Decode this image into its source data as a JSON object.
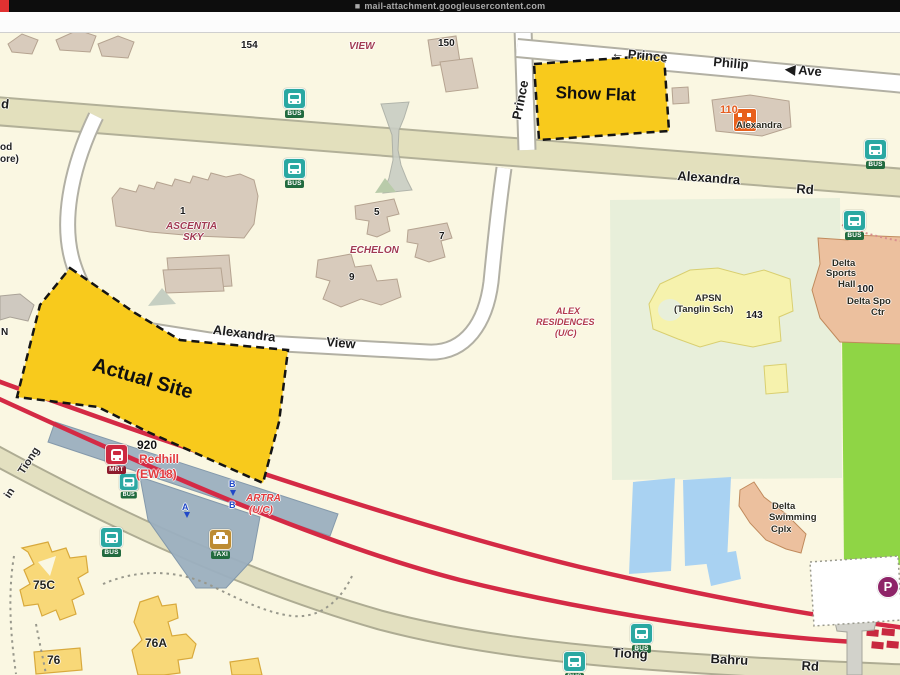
{
  "browser": {
    "url_prefix_glyph": "■",
    "url": "mail-attachment.googleusercontent.com"
  },
  "map": {
    "site_overlays": [
      {
        "name": "show-flat",
        "label": "Show Flat"
      },
      {
        "name": "actual-site",
        "label": "Actual Site"
      }
    ],
    "icon_labels": {
      "bus": "BUS",
      "mrt": "MRT",
      "taxi": "TAXI",
      "parking": "P"
    },
    "accent_colors": {
      "site_yellow": "#f8ca1c",
      "rail_red": "#d42a45",
      "bus_teal": "#2aa8a2",
      "mrt_red": "#cd2840",
      "parking_purple": "#8e2468"
    },
    "labels": [
      {
        "t": "154",
        "x": 241,
        "y": 40,
        "cls": "num"
      },
      {
        "t": "VIEW",
        "x": 349,
        "y": 41,
        "cls": "condo"
      },
      {
        "t": "150",
        "x": 438,
        "y": 38,
        "cls": "num"
      },
      {
        "t": "← Prince",
        "x": 612,
        "y": 45,
        "r": 5,
        "cls": "rd"
      },
      {
        "t": "Philip",
        "x": 714,
        "y": 54,
        "r": 5,
        "cls": "rd"
      },
      {
        "t": "◀ Ave",
        "x": 786,
        "y": 61,
        "r": 5,
        "cls": "rd"
      },
      {
        "t": "Prince",
        "x": 509,
        "y": 118,
        "r": -79,
        "cls": "rd"
      },
      {
        "t": "d",
        "x": 2,
        "y": 96,
        "r": 6,
        "cls": "rd"
      },
      {
        "t": "od",
        "x": 0,
        "y": 142,
        "cls": "partial"
      },
      {
        "t": "ore)",
        "x": 0,
        "y": 154,
        "cls": "partial"
      },
      {
        "t": "Alexandra",
        "x": 678,
        "y": 168,
        "r": 4,
        "cls": "rd"
      },
      {
        "t": "Rd",
        "x": 797,
        "y": 181,
        "r": 4,
        "cls": "rd"
      },
      {
        "t": "Alexandra",
        "x": 214,
        "y": 322,
        "r": 7,
        "cls": "rd"
      },
      {
        "t": "View",
        "x": 327,
        "y": 334,
        "r": 5,
        "cls": "rd"
      },
      {
        "t": "1",
        "x": 180,
        "y": 206,
        "cls": "num"
      },
      {
        "t": "ASCENTIA",
        "x": 166,
        "y": 221,
        "cls": "condo"
      },
      {
        "t": "SKY",
        "x": 183,
        "y": 232,
        "cls": "condo"
      },
      {
        "t": "5",
        "x": 374,
        "y": 207,
        "cls": "num"
      },
      {
        "t": "7",
        "x": 439,
        "y": 231,
        "cls": "num"
      },
      {
        "t": "ECHELON",
        "x": 350,
        "y": 245,
        "cls": "condo"
      },
      {
        "t": "9",
        "x": 349,
        "y": 272,
        "cls": "num"
      },
      {
        "t": "ALEX",
        "x": 556,
        "y": 306,
        "cls": "condo-sm"
      },
      {
        "t": "RESIDENCES",
        "x": 536,
        "y": 317,
        "cls": "condo-sm"
      },
      {
        "t": "(U/C)",
        "x": 555,
        "y": 328,
        "cls": "condo-sm"
      },
      {
        "t": "APSN",
        "x": 695,
        "y": 293,
        "cls": "dark-sm"
      },
      {
        "t": "(Tanglin Sch)",
        "x": 674,
        "y": 304,
        "cls": "dark-sm"
      },
      {
        "t": "143",
        "x": 746,
        "y": 310,
        "cls": "num"
      },
      {
        "t": "110",
        "x": 720,
        "y": 104,
        "cls": "orange"
      },
      {
        "t": "Alexandra",
        "x": 736,
        "y": 120,
        "cls": "dark-sm"
      },
      {
        "t": "Delta",
        "x": 832,
        "y": 258,
        "cls": "dark-sm"
      },
      {
        "t": "Sports",
        "x": 826,
        "y": 268,
        "cls": "dark-sm"
      },
      {
        "t": "Hall",
        "x": 838,
        "y": 279,
        "cls": "dark-sm"
      },
      {
        "t": "100",
        "x": 857,
        "y": 284,
        "cls": "num"
      },
      {
        "t": "Delta Spo",
        "x": 847,
        "y": 296,
        "cls": "dark-sm"
      },
      {
        "t": "Ctr",
        "x": 871,
        "y": 307,
        "cls": "dark-sm"
      },
      {
        "t": "Delta",
        "x": 772,
        "y": 501,
        "cls": "dark-sm"
      },
      {
        "t": "Swimming",
        "x": 769,
        "y": 512,
        "cls": "dark-sm"
      },
      {
        "t": "Cplx",
        "x": 771,
        "y": 524,
        "cls": "dark-sm"
      },
      {
        "t": "920",
        "x": 137,
        "y": 438,
        "cls": "num-lg"
      },
      {
        "t": "Redhill",
        "x": 139,
        "y": 452,
        "cls": "mrt-name"
      },
      {
        "t": "(EW18)",
        "x": 136,
        "y": 467,
        "cls": "mrt-name"
      },
      {
        "t": "ARTRA",
        "x": 246,
        "y": 493,
        "cls": "artra"
      },
      {
        "t": "(U/C)",
        "x": 249,
        "y": 505,
        "cls": "artra"
      },
      {
        "t": "B",
        "x": 229,
        "y": 479,
        "cls": "stop"
      },
      {
        "t": "B",
        "x": 229,
        "y": 500,
        "cls": "stop"
      },
      {
        "t": "A",
        "x": 182,
        "y": 502,
        "cls": "stop"
      },
      {
        "t": "75C",
        "x": 33,
        "y": 578,
        "cls": "hdb"
      },
      {
        "t": "76A",
        "x": 145,
        "y": 636,
        "cls": "hdb"
      },
      {
        "t": "76",
        "x": 47,
        "y": 653,
        "cls": "hdb"
      },
      {
        "t": "Tiong",
        "x": 613,
        "y": 645,
        "r": 3,
        "cls": "rd"
      },
      {
        "t": "Bahru",
        "x": 711,
        "y": 651,
        "r": 3,
        "cls": "rd"
      },
      {
        "t": "Rd",
        "x": 802,
        "y": 658,
        "r": 3,
        "cls": "rd"
      },
      {
        "t": "Tiong",
        "x": 16,
        "y": 470,
        "r": -57,
        "cls": "rd-sm"
      },
      {
        "t": "in",
        "x": 2,
        "y": 494,
        "r": -57,
        "cls": "rd-sm"
      },
      {
        "t": "N",
        "x": 1,
        "y": 327,
        "cls": "num"
      },
      {
        "t": "Show Flat",
        "x": 556,
        "y": 83,
        "r": 2,
        "cls": "site-label",
        "fs": 17
      },
      {
        "t": "Actual Site",
        "x": 96,
        "y": 354,
        "r": 16,
        "cls": "site-label",
        "fs": 20
      }
    ],
    "icons": [
      {
        "type": "bus",
        "x": 283,
        "y": 88
      },
      {
        "type": "bus",
        "x": 283,
        "y": 158
      },
      {
        "type": "bus",
        "x": 864,
        "y": 139
      },
      {
        "type": "bus",
        "x": 843,
        "y": 210
      },
      {
        "type": "bus",
        "x": 119,
        "y": 473,
        "small": true
      },
      {
        "type": "bus",
        "x": 100,
        "y": 527
      },
      {
        "type": "bus",
        "x": 630,
        "y": 623
      },
      {
        "type": "bus",
        "x": 563,
        "y": 651
      },
      {
        "type": "mrt",
        "x": 105,
        "y": 444
      },
      {
        "type": "taxi",
        "x": 209,
        "y": 529
      },
      {
        "type": "parking",
        "x": 877,
        "y": 576
      },
      {
        "type": "shop",
        "x": 733,
        "y": 108
      }
    ]
  }
}
